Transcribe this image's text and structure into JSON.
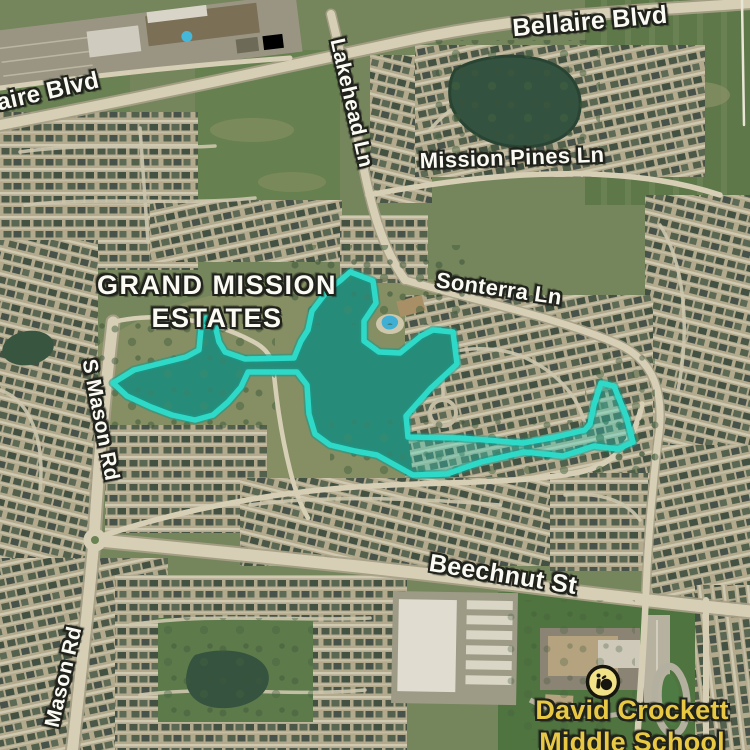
{
  "map": {
    "view": "satellite",
    "labels": {
      "bellaire_top": "Bellaire Blvd",
      "bellaire_left": "aire Blvd",
      "lakehead": "Lakehead Ln",
      "mission_pines": "Mission Pines Ln",
      "grand_mission_line1": "GRAND MISSION",
      "grand_mission_line2": "ESTATES",
      "sonterra": "Sonterra Ln",
      "s_mason": "S Mason Rd",
      "mason": "Mason Rd",
      "beechnut": "Beechnut St",
      "school_line1": "David Crockett",
      "school_line2": "Middle School"
    },
    "colors": {
      "zone_stroke": "#2fd9c7",
      "zone_glow": "#18998a",
      "zone_fill": "rgba(47,217,199,0.33)",
      "school_label": "#e9c944",
      "marker_bg": "#f1e288",
      "marker_ink": "#17150f"
    },
    "zone_polygon": [
      [
        113,
        383
      ],
      [
        134,
        370
      ],
      [
        186,
        357
      ],
      [
        199,
        350
      ],
      [
        201,
        329
      ],
      [
        206,
        318
      ],
      [
        214,
        321
      ],
      [
        219,
        342
      ],
      [
        225,
        352
      ],
      [
        245,
        359
      ],
      [
        294,
        358
      ],
      [
        301,
        341
      ],
      [
        308,
        330
      ],
      [
        312,
        311
      ],
      [
        328,
        290
      ],
      [
        341,
        280
      ],
      [
        350,
        272
      ],
      [
        358,
        275
      ],
      [
        373,
        281
      ],
      [
        376,
        303
      ],
      [
        364,
        321
      ],
      [
        364,
        341
      ],
      [
        379,
        352
      ],
      [
        400,
        353
      ],
      [
        421,
        336
      ],
      [
        433,
        330
      ],
      [
        453,
        332
      ],
      [
        457,
        364
      ],
      [
        431,
        388
      ],
      [
        406,
        416
      ],
      [
        408,
        437
      ],
      [
        460,
        438
      ],
      [
        523,
        443
      ],
      [
        556,
        437
      ],
      [
        585,
        430
      ],
      [
        590,
        424
      ],
      [
        594,
        405
      ],
      [
        601,
        383
      ],
      [
        614,
        386
      ],
      [
        626,
        416
      ],
      [
        633,
        442
      ],
      [
        618,
        449
      ],
      [
        594,
        446
      ],
      [
        563,
        456
      ],
      [
        524,
        452
      ],
      [
        481,
        462
      ],
      [
        447,
        474
      ],
      [
        413,
        475
      ],
      [
        395,
        465
      ],
      [
        377,
        455
      ],
      [
        355,
        451
      ],
      [
        330,
        445
      ],
      [
        315,
        434
      ],
      [
        309,
        414
      ],
      [
        307,
        385
      ],
      [
        297,
        372
      ],
      [
        248,
        372
      ],
      [
        241,
        387
      ],
      [
        228,
        402
      ],
      [
        213,
        415
      ],
      [
        195,
        420
      ],
      [
        172,
        415
      ],
      [
        151,
        407
      ],
      [
        127,
        396
      ]
    ],
    "school_marker": {
      "cx": 603,
      "cy": 682,
      "r": 15.5
    }
  }
}
